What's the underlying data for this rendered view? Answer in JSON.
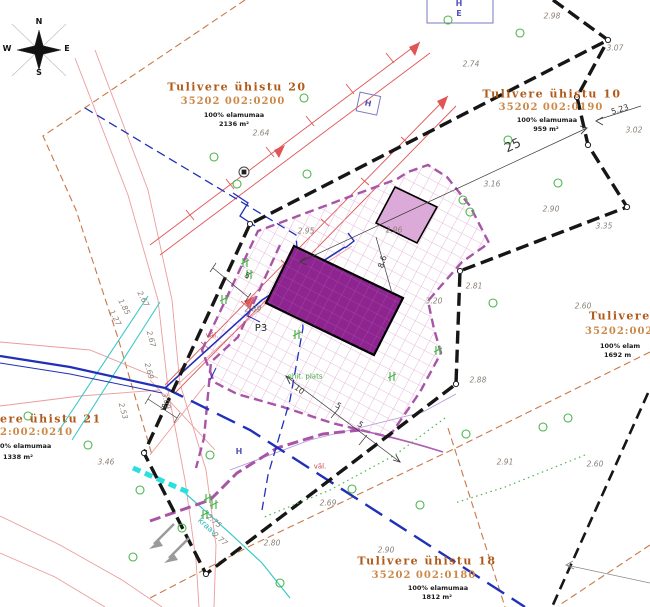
{
  "colors": {
    "parcel_title": "#b05a1a",
    "parcel_code": "#cc8a4a",
    "boundary": "#161616",
    "planned_fence": "#a855a8",
    "building_fill": "#8e2490",
    "small_building_fill": "#dcaad8",
    "hatch_line": "#dfa8d0",
    "water_line": "#2030b8",
    "ditch_line": "#3cc8c8",
    "power_line": "#e05555",
    "road_line": "#c87848",
    "vegetation": "#4db54d"
  },
  "compass": {
    "north": "N",
    "south": "S",
    "east": "E",
    "west": "W"
  },
  "parcels": [
    {
      "name": "parcel-20-label",
      "lines": [
        {
          "t": "Tulivere ühistu 20",
          "x": 237,
          "y": 87,
          "cls": "parcel-title"
        },
        {
          "t": "35202 002:0200",
          "x": 233,
          "y": 102,
          "cls": "parcel-code"
        },
        {
          "t": "100% elamumaa",
          "x": 234,
          "y": 115,
          "cls": "parcel-sub"
        },
        {
          "t": "2136 m²",
          "x": 234,
          "y": 124,
          "cls": "parcel-sub"
        }
      ]
    },
    {
      "name": "parcel-10-label",
      "lines": [
        {
          "t": "Tulivere ühistu 10",
          "x": 552,
          "y": 94,
          "cls": "parcel-title"
        },
        {
          "t": "35202 002:0190",
          "x": 551,
          "y": 108,
          "cls": "parcel-code"
        },
        {
          "t": "100% elamumaa",
          "x": 547,
          "y": 120,
          "cls": "parcel-sub"
        },
        {
          "t": "959 m²",
          "x": 546,
          "y": 129,
          "cls": "parcel-sub"
        }
      ]
    },
    {
      "name": "parcel-18-label",
      "lines": [
        {
          "t": "Tulivere ühistu 18",
          "x": 427,
          "y": 561,
          "cls": "parcel-title"
        },
        {
          "t": "35202 002:0180",
          "x": 424,
          "y": 576,
          "cls": "parcel-code"
        },
        {
          "t": "100% elamumaa",
          "x": 438,
          "y": 588,
          "cls": "parcel-sub"
        },
        {
          "t": "1812 m²",
          "x": 437,
          "y": 597,
          "cls": "parcel-sub"
        }
      ]
    },
    {
      "name": "parcel-right-label",
      "lines": [
        {
          "t": "Tulivere üh",
          "x": 589,
          "y": 316,
          "cls": "parcel-title",
          "left": true
        },
        {
          "t": "35202:002:0",
          "x": 585,
          "y": 332,
          "cls": "parcel-code",
          "left": true
        },
        {
          "t": "100% elam",
          "x": 600,
          "y": 346,
          "cls": "parcel-sub",
          "left": true
        },
        {
          "t": "1692 m",
          "x": 604,
          "y": 355,
          "cls": "parcel-sub",
          "left": true
        }
      ]
    },
    {
      "name": "parcel-21-label",
      "lines": [
        {
          "t": "ere ühistu 21",
          "x": 0,
          "y": 419,
          "cls": "parcel-title",
          "left": true
        },
        {
          "t": "2:002:0210",
          "x": 0,
          "y": 433,
          "cls": "parcel-code",
          "left": true
        },
        {
          "t": "0% elamumaa",
          "x": 0,
          "y": 446,
          "cls": "parcel-sub",
          "left": true
        },
        {
          "t": "1338 m²",
          "x": 3,
          "y": 457,
          "cls": "parcel-sub",
          "left": true
        }
      ]
    }
  ],
  "spot_elevations": [
    {
      "v": "2.98",
      "x": 552,
      "y": 16
    },
    {
      "v": "3.07",
      "x": 615,
      "y": 48
    },
    {
      "v": "2.74",
      "x": 471,
      "y": 64
    },
    {
      "v": "3.02",
      "x": 634,
      "y": 130
    },
    {
      "v": "2.64",
      "x": 261,
      "y": 133
    },
    {
      "v": "2.95",
      "x": 306,
      "y": 231
    },
    {
      "v": "2.96",
      "x": 394,
      "y": 230
    },
    {
      "v": "3.16",
      "x": 492,
      "y": 184
    },
    {
      "v": "2.90",
      "x": 551,
      "y": 209
    },
    {
      "v": "3.35",
      "x": 604,
      "y": 226
    },
    {
      "v": "2.60",
      "x": 583,
      "y": 306
    },
    {
      "v": "2.81",
      "x": 474,
      "y": 286
    },
    {
      "v": "3.20",
      "x": 434,
      "y": 301
    },
    {
      "v": "2.89",
      "x": 253,
      "y": 309
    },
    {
      "v": "2.88",
      "x": 478,
      "y": 380
    },
    {
      "v": "2.91",
      "x": 505,
      "y": 462
    },
    {
      "v": "2.69",
      "x": 328,
      "y": 503
    },
    {
      "v": "2.80",
      "x": 272,
      "y": 543
    },
    {
      "v": "2.90",
      "x": 386,
      "y": 550
    },
    {
      "v": "2.60",
      "x": 595,
      "y": 464
    },
    {
      "v": "3.46",
      "x": 106,
      "y": 462
    },
    {
      "v": "2.53",
      "x": 123,
      "y": 411,
      "rot": 75
    },
    {
      "v": "2.69",
      "x": 149,
      "y": 371,
      "rot": 75
    },
    {
      "v": "2.67",
      "x": 151,
      "y": 339,
      "rot": 75
    },
    {
      "v": "3.09",
      "x": 166,
      "y": 401,
      "rot": 75
    },
    {
      "v": "1.27",
      "x": 115,
      "y": 318,
      "rot": 62
    },
    {
      "v": "1.85",
      "x": 124,
      "y": 307,
      "rot": 62
    },
    {
      "v": "2.67",
      "x": 143,
      "y": 299,
      "rot": 62
    },
    {
      "v": "2.75",
      "x": 214,
      "y": 521,
      "rot": 40
    },
    {
      "v": "2.77",
      "x": 220,
      "y": 539,
      "rot": 40
    }
  ],
  "dimensions": [
    {
      "v": "25",
      "x": 513,
      "y": 146,
      "rot": -25,
      "size": 13
    },
    {
      "v": "5",
      "x": 247,
      "y": 276,
      "rot": 25
    },
    {
      "v": "5",
      "x": 163,
      "y": 408,
      "rot": 15
    },
    {
      "v": "10",
      "x": 299,
      "y": 390,
      "rot": 37
    },
    {
      "v": "5",
      "x": 338,
      "y": 406,
      "rot": 37
    },
    {
      "v": "5",
      "x": 360,
      "y": 425,
      "rot": 37
    },
    {
      "v": "8.6",
      "x": 383,
      "y": 262,
      "rot": -72
    },
    {
      "v": "5.23",
      "x": 620,
      "y": 110,
      "rot": -17
    }
  ],
  "annotations": [
    {
      "t": "P3",
      "x": 261,
      "y": 329,
      "cls": "lbl-black",
      "name": "point-label-p3"
    },
    {
      "t": "kraav",
      "x": 207,
      "y": 527,
      "rot": 42,
      "cls": "lbl-cyan",
      "name": "ditch-label"
    },
    {
      "t": "väl.",
      "x": 212,
      "y": 336,
      "cls": "lbl-red",
      "name": "outlet-label"
    },
    {
      "t": "väl.",
      "x": 320,
      "y": 467,
      "cls": "lbl-red",
      "name": "outlet-label"
    },
    {
      "t": "ehit. plats",
      "x": 305,
      "y": 377,
      "cls": "lbl-green",
      "name": "site-area-label"
    },
    {
      "t": "H",
      "x": 459,
      "y": 4,
      "cls": "lbl-blue",
      "name": "hydrant-letter"
    },
    {
      "t": "E",
      "x": 459,
      "y": 14,
      "cls": "lbl-blue",
      "name": "hydrant-letter"
    },
    {
      "t": "H",
      "x": 368,
      "y": 104,
      "rot": 12,
      "cls": "lbl-blue",
      "name": "hydrant-letter"
    },
    {
      "t": "H",
      "x": 239,
      "y": 452,
      "cls": "lbl-blue",
      "name": "hydrant-letter"
    }
  ]
}
